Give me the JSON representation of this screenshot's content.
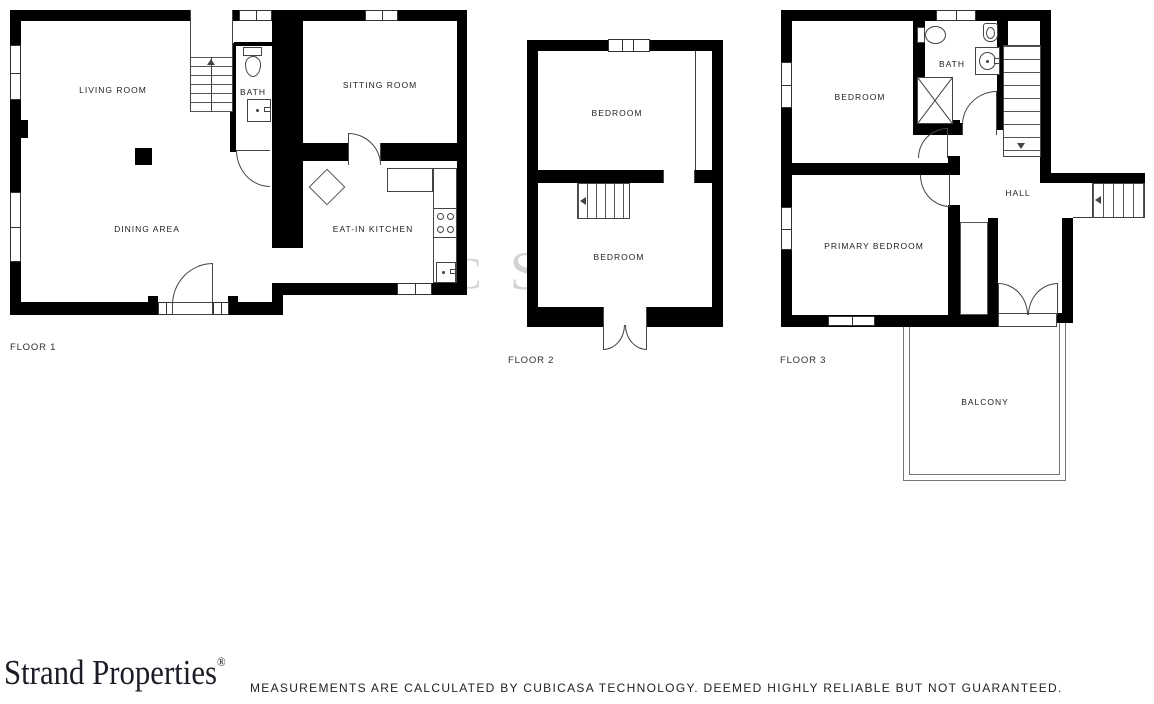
{
  "floor1": {
    "label": "FLOOR 1",
    "living_room": "LIVING ROOM",
    "bath": "BATH",
    "sitting_room": "SITTING ROOM",
    "dining_area": "DINING AREA",
    "kitchen": "EAT-IN KITCHEN"
  },
  "floor2": {
    "label": "FLOOR 2",
    "bedroom_top": "BEDROOM",
    "bedroom_bottom": "BEDROOM"
  },
  "floor3": {
    "label": "FLOOR 3",
    "bedroom": "BEDROOM",
    "bath": "BATH",
    "hall": "HALL",
    "primary_bedroom": "PRIMARY BEDROOM",
    "balcony": "BALCONY"
  },
  "watermark": {
    "fragment_left": "C",
    "fragment_right": "S"
  },
  "branding": {
    "logo_text": "Strand Properties",
    "registered_mark": "®"
  },
  "footer": {
    "disclaimer": "MEASUREMENTS ARE CALCULATED BY CUBICASA TECHNOLOGY. DEEMED HIGHLY RELIABLE BUT NOT GUARANTEED."
  },
  "colors": {
    "wall": "#000000",
    "thin_line": "#3f3f3f",
    "label_text": "#1f1f1f",
    "logo_text": "#1c1c26",
    "watermark": "#d3d3d3"
  }
}
